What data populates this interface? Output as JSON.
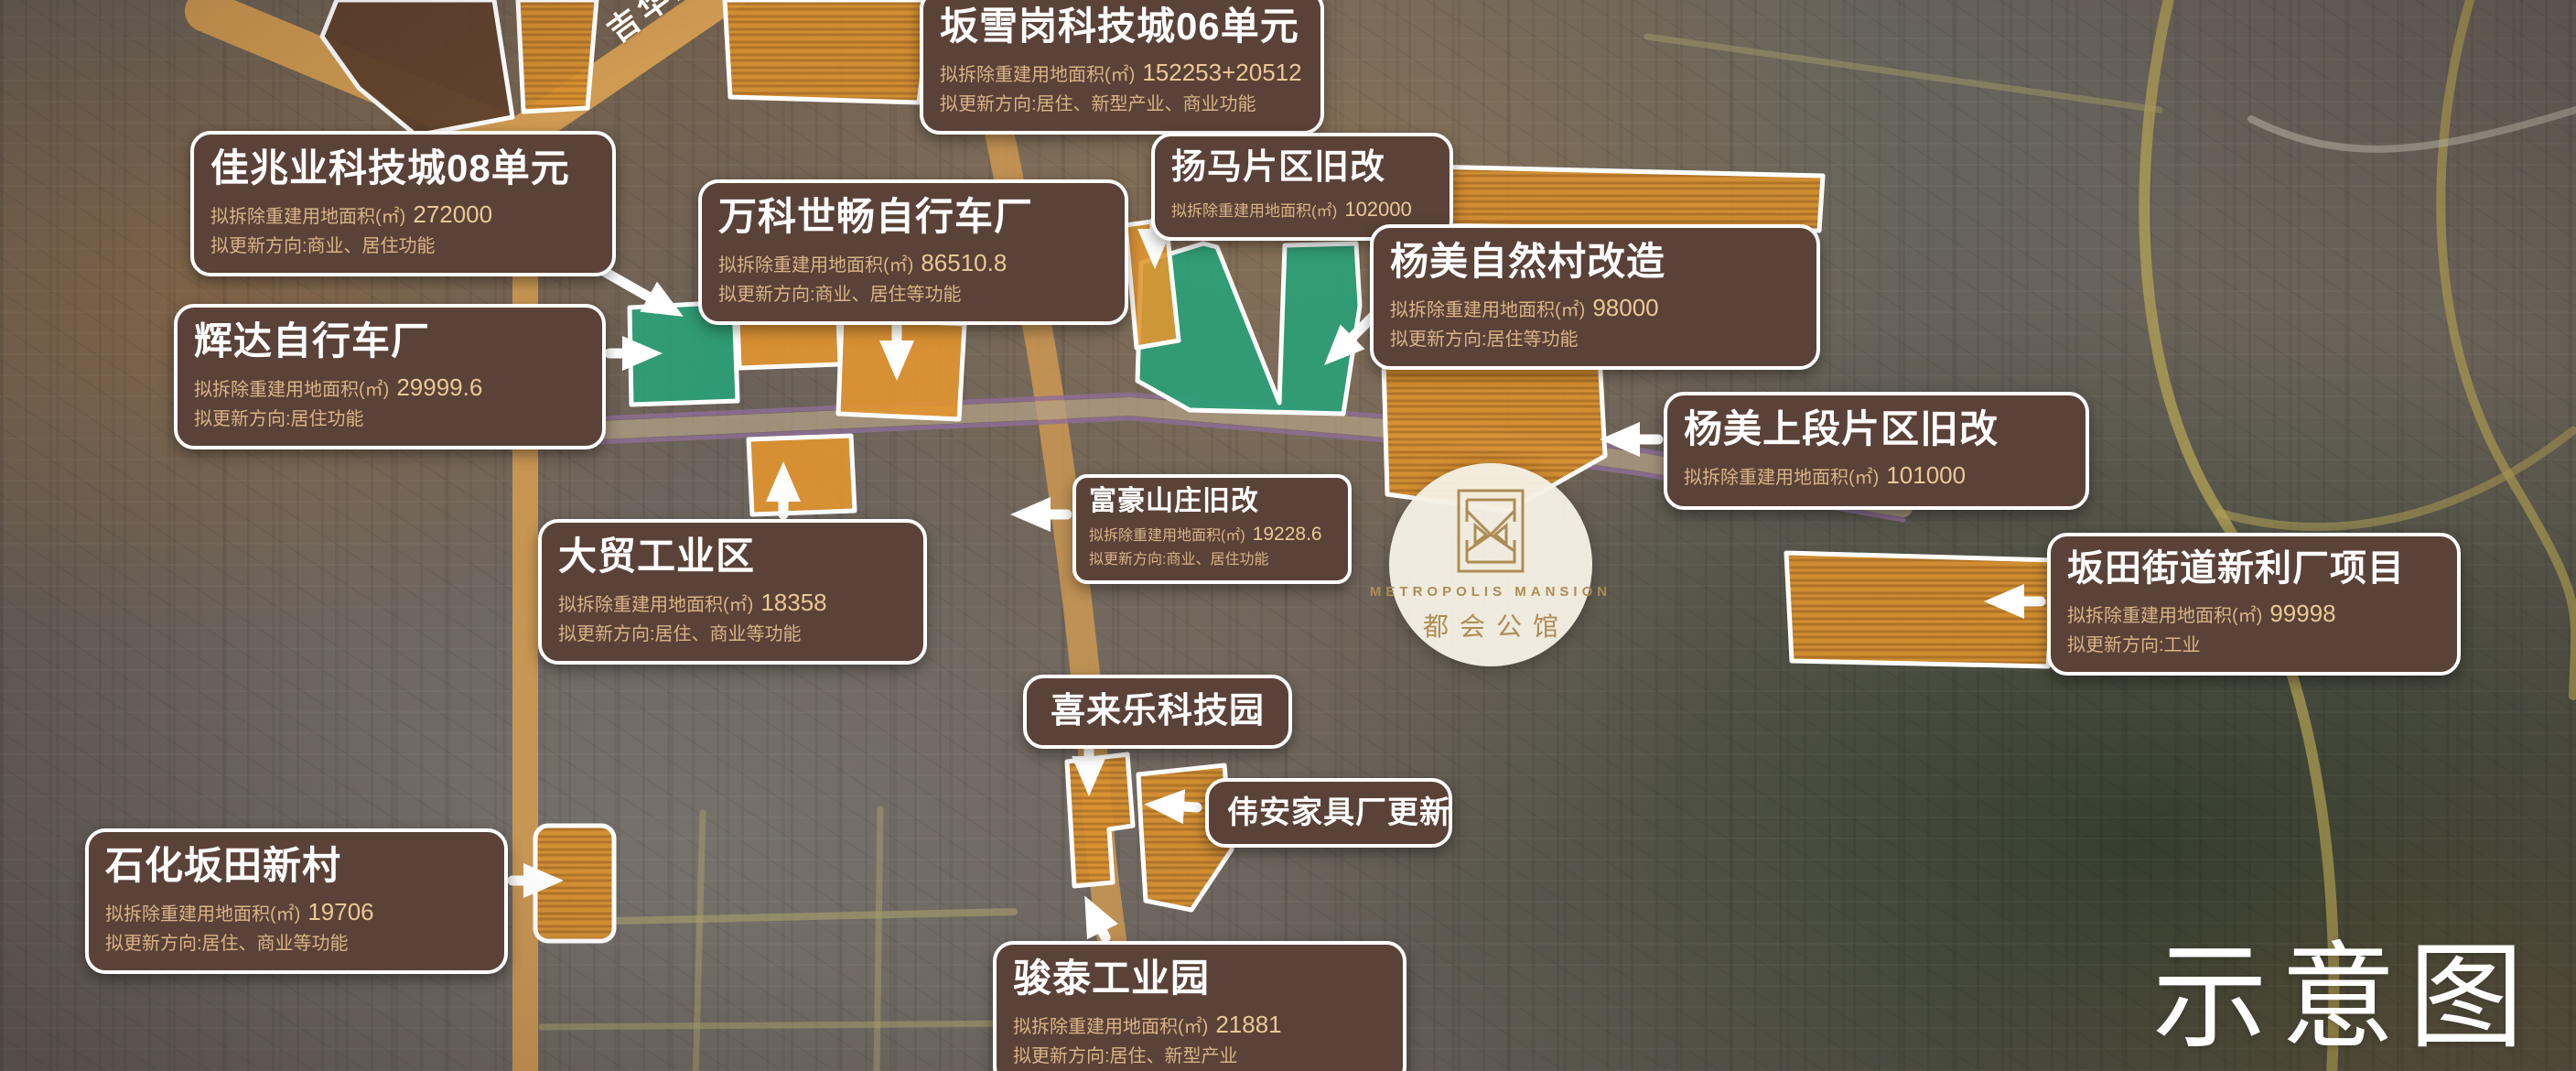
{
  "page": {
    "watermark": "示意图",
    "road_label": "吉华路"
  },
  "logo": {
    "name_en": "METROPOLIS MANSION",
    "name_cn": "都会公馆"
  },
  "colors": {
    "label_bg": "#5b4238",
    "label_border": "#ffffff",
    "detail_text": "#d8b486",
    "value_text": "#e9c995",
    "parcel_orange": "#e2952f",
    "parcel_green": "#2aa077",
    "parcel_dark": "#5f402c",
    "road_orange": "#cf9a52",
    "road_purple": "#8f6e99",
    "road_yellow": "#b3a355",
    "logo_gold": "#ad8d55"
  },
  "labels": [
    {
      "id": "banxuegang-06",
      "title": "坂雪岗科技城06单元",
      "area_label": "拟拆除重建用地面积(㎡)",
      "area_value": "152253+20512",
      "direction": "拟更新方向:居住、新型产业、商业功能"
    },
    {
      "id": "jiazhaoye-08",
      "title": "佳兆业科技城08单元",
      "area_label": "拟拆除重建用地面积(㎡)",
      "area_value": "272000",
      "direction": "拟更新方向:商业、居住功能"
    },
    {
      "id": "wanke-shichang",
      "title": "万科世畅自行车厂",
      "area_label": "拟拆除重建用地面积(㎡)",
      "area_value": "86510.8",
      "direction": "拟更新方向:商业、居住等功能"
    },
    {
      "id": "yangma",
      "title": "扬马片区旧改",
      "area_label": "拟拆除重建用地面积(㎡)",
      "area_value": "102000"
    },
    {
      "id": "yangmei-village",
      "title": "杨美自然村改造",
      "area_label": "拟拆除重建用地面积(㎡)",
      "area_value": "98000",
      "direction": "拟更新方向:居住等功能"
    },
    {
      "id": "huida",
      "title": "辉达自行车厂",
      "area_label": "拟拆除重建用地面积(㎡)",
      "area_value": "29999.6",
      "direction": "拟更新方向:居住功能"
    },
    {
      "id": "yangmei-upper",
      "title": "杨美上段片区旧改",
      "area_label": "拟拆除重建用地面积(㎡)",
      "area_value": "101000"
    },
    {
      "id": "fuhao",
      "title": "富豪山庄旧改",
      "area_label": "拟拆除重建用地面积(㎡)",
      "area_value": "19228.6",
      "direction": "拟更新方向:商业、居住功能"
    },
    {
      "id": "xinli",
      "title": "坂田街道新利厂项目",
      "area_label": "拟拆除重建用地面积(㎡)",
      "area_value": "99998",
      "direction": "拟更新方向:工业"
    },
    {
      "id": "damao",
      "title": "大贸工业区",
      "area_label": "拟拆除重建用地面积(㎡)",
      "area_value": "18358",
      "direction": "拟更新方向:居住、商业等功能"
    },
    {
      "id": "xilaile",
      "title": "喜来乐科技园"
    },
    {
      "id": "weian",
      "title": "伟安家具厂更新"
    },
    {
      "id": "shihua",
      "title": "石化坂田新村",
      "area_label": "拟拆除重建用地面积(㎡)",
      "area_value": "19706",
      "direction": "拟更新方向:居住、商业等功能"
    },
    {
      "id": "juntai",
      "title": "骏泰工业园",
      "area_label": "拟拆除重建用地面积(㎡)",
      "area_value": "21881",
      "direction": "拟更新方向:居住、新型产业"
    }
  ]
}
